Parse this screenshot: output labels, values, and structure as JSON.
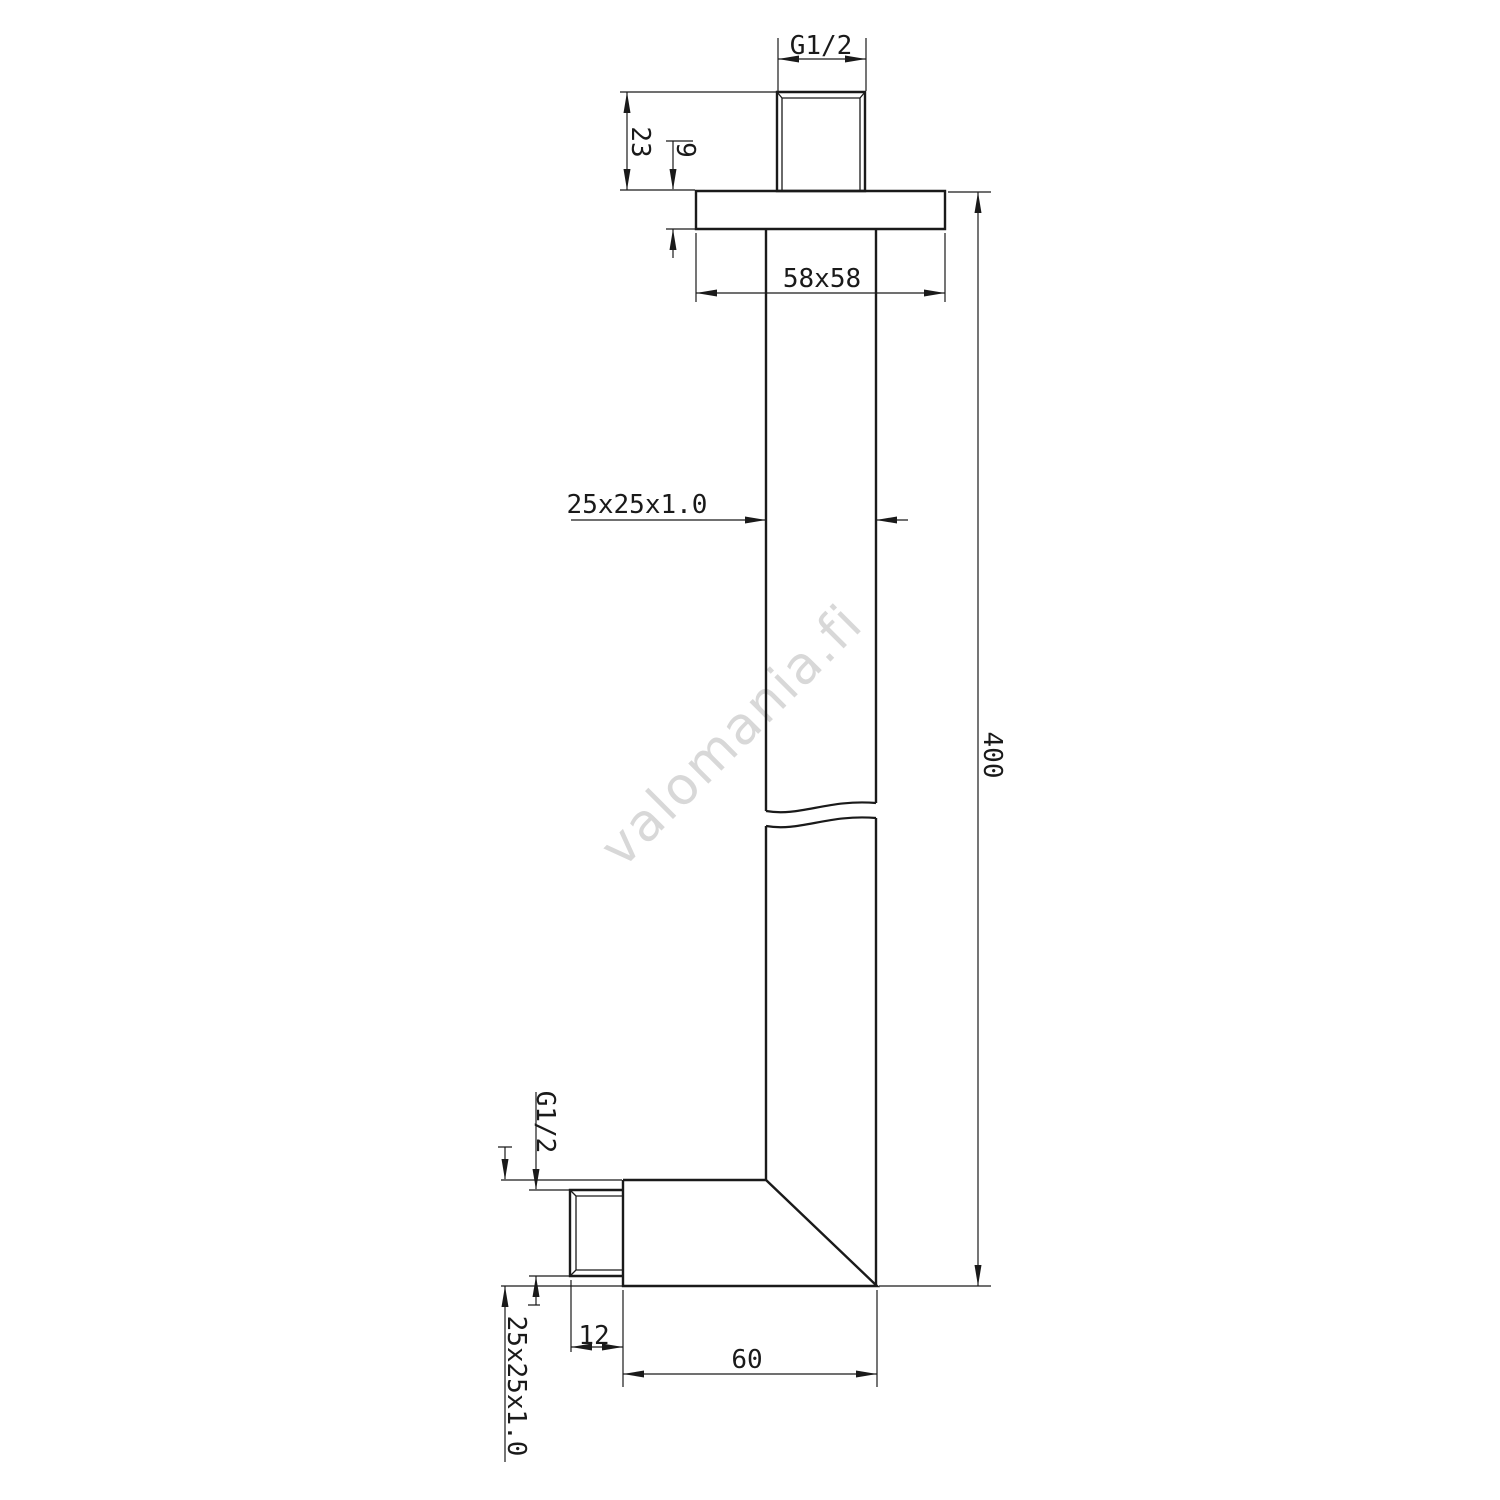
{
  "drawing": {
    "type": "technical-dimension-drawing",
    "subject": "square ceiling shower arm, side view with break symbol",
    "colors": {
      "line": "#1a1a1a",
      "watermark_text": "#d8d8d8",
      "background": "#ffffff"
    },
    "watermark": "valomania.fi",
    "dimensions": {
      "thread_top": "G1/2",
      "stub_height": "23",
      "flange_thickness": "9",
      "flange_plate": "58x58",
      "tube_profile": "25x25x1.0",
      "overall_length": "400",
      "thread_bottom": "G1/2",
      "arm_profile": "25x25x1.0",
      "thread_offset": "12",
      "arm_length": "60"
    }
  }
}
